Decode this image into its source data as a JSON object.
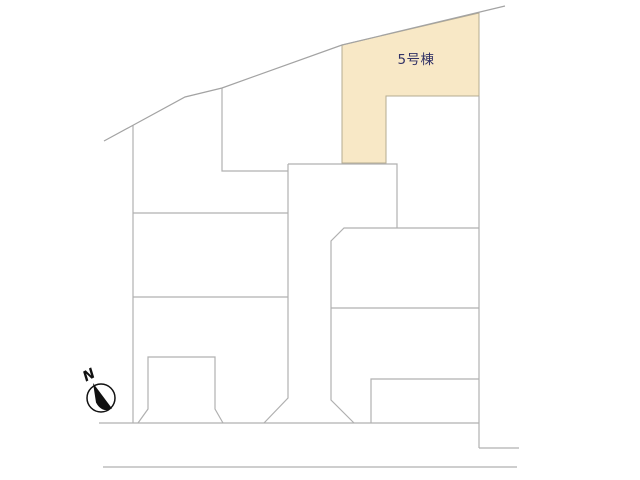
{
  "plan": {
    "background_color": "#ffffff",
    "colors": {
      "line": "#b0b0b0",
      "boundary": "#a3a3a3",
      "highlight_fill": "#f8e8c6",
      "highlight_stroke": "#b5ab90",
      "label_text": "#333366",
      "compass": "#111111"
    },
    "highlighted_lot": {
      "label": "5号棟",
      "fill": "#f8e8c6",
      "points": [
        [
          342,
          45
        ],
        [
          479,
          13
        ],
        [
          479,
          96
        ],
        [
          386,
          96
        ],
        [
          386,
          163
        ],
        [
          342,
          163
        ]
      ],
      "label_pos": [
        416,
        64
      ]
    },
    "boundary": {
      "name": "site-north-boundary-line",
      "points": [
        [
          104,
          141
        ],
        [
          185,
          97
        ],
        [
          222,
          88
        ],
        [
          342,
          45
        ],
        [
          505,
          6
        ]
      ]
    },
    "lines": [
      {
        "name": "west-lot-edge-line",
        "points": [
          [
            133,
            125
          ],
          [
            133,
            423
          ]
        ]
      },
      {
        "name": "partition-line-upper",
        "points": [
          [
            133,
            213
          ],
          [
            288,
            213
          ]
        ]
      },
      {
        "name": "partition-line-lower",
        "points": [
          [
            133,
            297
          ],
          [
            288,
            297
          ]
        ]
      },
      {
        "name": "north-lot-partition-line",
        "points": [
          [
            222,
            88
          ],
          [
            222,
            171
          ],
          [
            288,
            171
          ]
        ]
      },
      {
        "name": "driveway-left-edge-line",
        "points": [
          [
            288,
            164
          ],
          [
            288,
            398
          ],
          [
            264,
            423
          ]
        ]
      },
      {
        "name": "center-building-outline",
        "points": [
          [
            288,
            164
          ],
          [
            397,
            164
          ],
          [
            397,
            228
          ]
        ]
      },
      {
        "name": "driveway-right-edge-line",
        "points": [
          [
            479,
            228
          ],
          [
            344,
            228
          ],
          [
            331,
            241
          ],
          [
            331,
            400
          ],
          [
            354,
            423
          ]
        ]
      },
      {
        "name": "east-partition-line",
        "points": [
          [
            331,
            308
          ],
          [
            479,
            308
          ]
        ]
      },
      {
        "name": "southeast-building-outline",
        "points": [
          [
            371,
            423
          ],
          [
            371,
            379
          ],
          [
            479,
            379
          ]
        ]
      },
      {
        "name": "east-lot-edge-line",
        "points": [
          [
            479,
            96
          ],
          [
            479,
            448
          ]
        ]
      },
      {
        "name": "east-boundary-step-line",
        "points": [
          [
            479,
            448
          ],
          [
            519,
            448
          ]
        ]
      },
      {
        "name": "road-edge-upper-line",
        "points": [
          [
            99,
            423
          ],
          [
            479,
            423
          ]
        ]
      },
      {
        "name": "road-edge-lower-line",
        "points": [
          [
            103,
            467
          ],
          [
            517,
            467
          ]
        ]
      },
      {
        "name": "southwest-parking-outline",
        "points": [
          [
            138,
            423
          ],
          [
            148,
            409
          ],
          [
            148,
            357
          ],
          [
            215,
            357
          ],
          [
            215,
            409
          ],
          [
            223,
            423
          ]
        ]
      }
    ],
    "compass": {
      "label": "N",
      "cx": 101,
      "cy": 398,
      "r": 14,
      "needle_path": "M93,383 L112,408.5 Q102,413.5 96,402.5 Z",
      "label_pos": [
        91,
        379
      ],
      "label_rotation": -28
    }
  }
}
